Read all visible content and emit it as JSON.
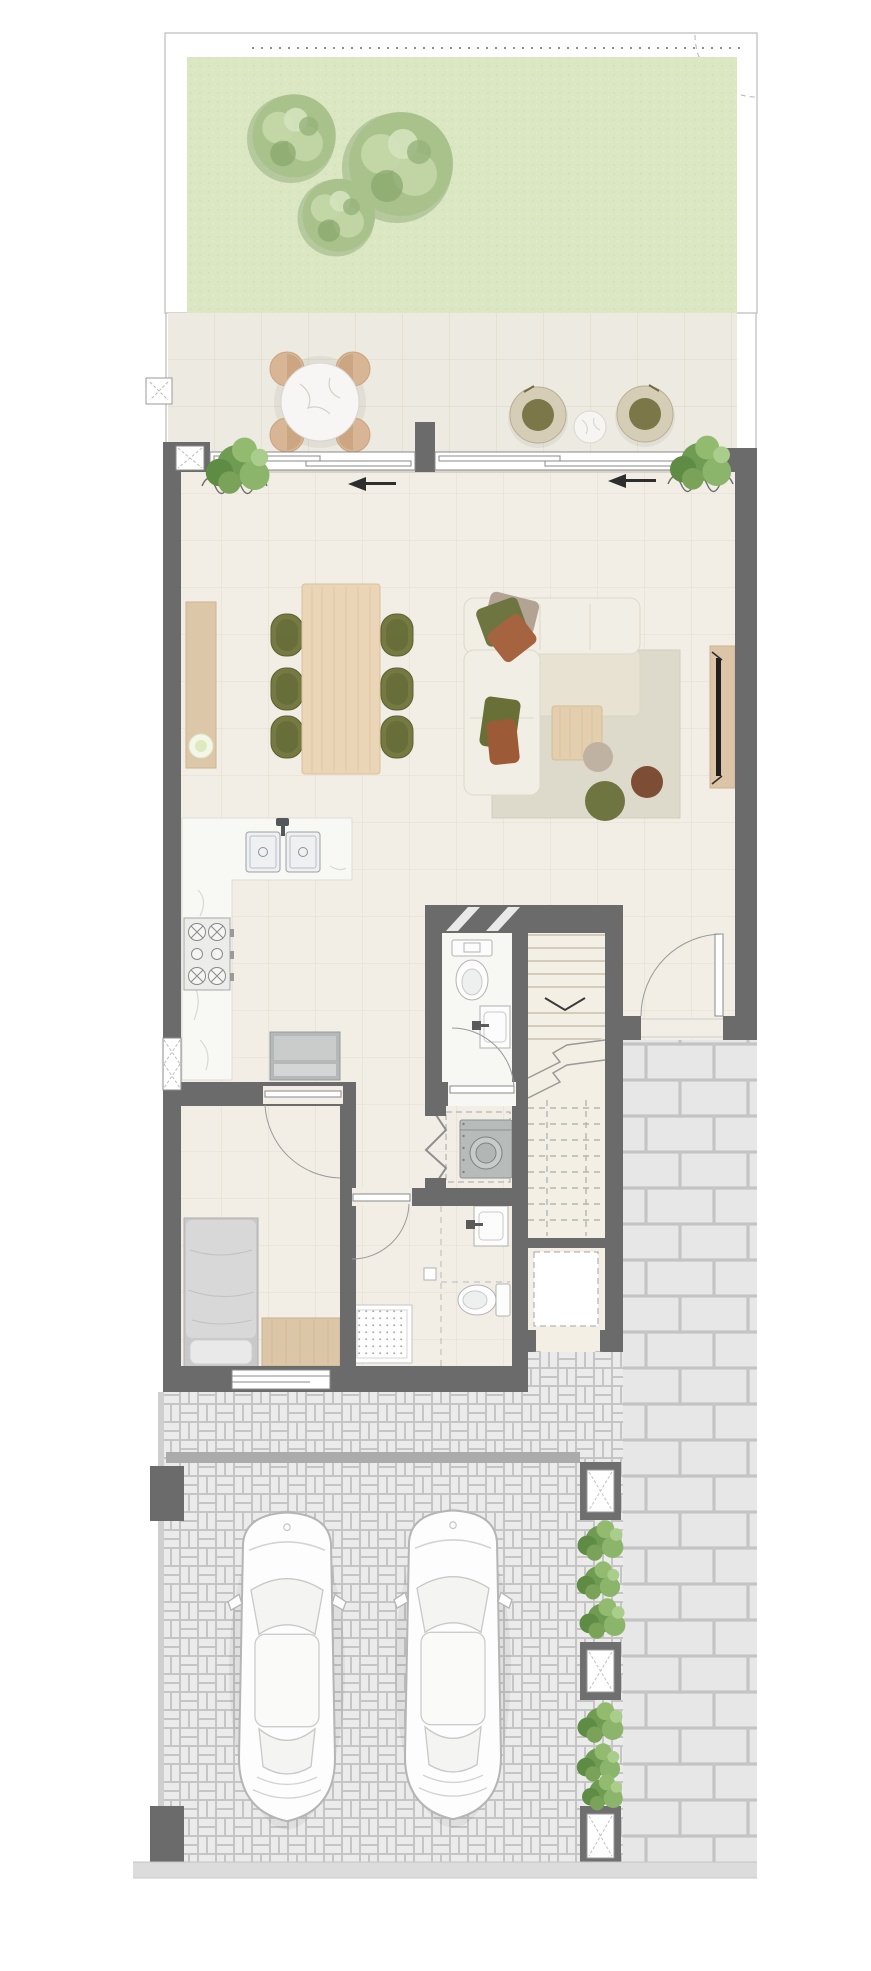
{
  "document": {
    "type": "architectural-floor-plan",
    "view": "top-down ground floor plan, rendered color style",
    "visible_text": []
  },
  "palette": {
    "background": "#ffffff",
    "wall": "#6b6b6b",
    "boundary_line": "#c0c0c0",
    "garden_grass": "#dbe6c3",
    "tree_green": "#a9c28c",
    "terrace_tile": "#edeae1",
    "interior_floor": "#f2eee6",
    "grid_line": "#e0d9cb",
    "wood_light": "#ead6b7",
    "wood_tan": "#dcc5a6",
    "olive_green": "#747a41",
    "rust": "#a5633f",
    "marble_white": "#f8f8f5",
    "rug_beige": "#dedacb",
    "paving_brick": "#e6e6e6",
    "paving_joint": "#bfbfbf",
    "plant_green": "#7aa258",
    "appliance_gray": "#b7bbb9"
  },
  "areas": {
    "garden": {
      "name": "garden",
      "features": [
        "lawn",
        "tree-canopy x3",
        "dashed boundary with gate swing"
      ]
    },
    "terrace": {
      "name": "terrace",
      "furniture": [
        "round-dining-table",
        "terrace-chair x4",
        "lounge-chair x2",
        "side-table",
        "shrub x2",
        "privacy-wall-pier",
        "structural-column"
      ]
    },
    "living_dining": {
      "name": "living-dining",
      "furniture": [
        "sliding-door x2",
        "curtain x2",
        "section-arrow x2",
        "sideboard-with-bowl",
        "dining-table",
        "dining-chair x6",
        "l-shaped-sofa",
        "cushion x5",
        "area-rug",
        "coffee-table",
        "pouf x3",
        "tv-console",
        "tv"
      ]
    },
    "kitchen": {
      "name": "kitchen",
      "features": [
        "l-shaped-marble-counter",
        "double-sink",
        "faucet",
        "cooktop-6-burner",
        "refrigerator",
        "x-window"
      ]
    },
    "powder_room": {
      "name": "powder-room",
      "fixtures": [
        "toilet",
        "washbasin",
        "door-swing"
      ]
    },
    "staircase": {
      "name": "staircase",
      "features": [
        "treads",
        "up-arrow",
        "break-line",
        "dashed-upper-flight"
      ]
    },
    "entry": {
      "name": "entry",
      "features": [
        "entry-door",
        "door-swing"
      ]
    },
    "utility_closet": {
      "name": "utility-closet",
      "features": [
        "washing-machine",
        "bifold-door",
        "dashed-shelf"
      ]
    },
    "bathroom": {
      "name": "bathroom",
      "fixtures": [
        "shower-tray-dotted",
        "toilet",
        "washbasin",
        "door-swing",
        "paper-holder"
      ]
    },
    "bedroom": {
      "name": "bedroom",
      "furniture": [
        "single-bed",
        "pillow",
        "dresser",
        "window",
        "door-swing"
      ]
    },
    "understair_storage": {
      "name": "understair-storage",
      "features": [
        "dashed-storage-pad",
        "double-outswing-doors"
      ]
    },
    "side_path": {
      "name": "side-path",
      "paving": "running-bond brick"
    },
    "driveway": {
      "name": "driveway",
      "paving": "herringbone/basketweave brick",
      "cars": 2,
      "planters": 3,
      "plants": 2,
      "gate_line": true,
      "gate_piers": 2,
      "sidewalk": true
    }
  }
}
